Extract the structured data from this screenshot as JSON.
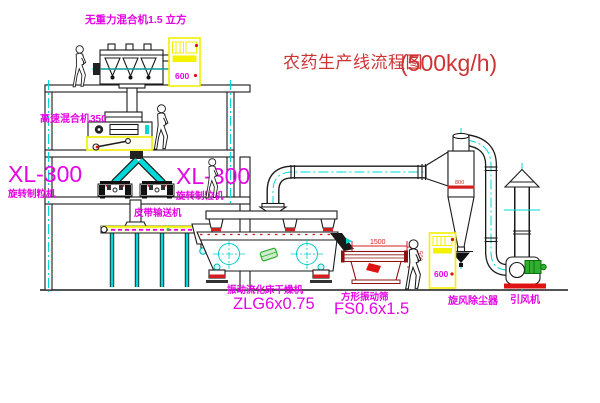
{
  "title": {
    "name": "农药生产线流程图",
    "capacity": "(500kg/h)"
  },
  "labels": {
    "gravity_mixer": "无重力混合机1.5 立方",
    "high_speed_mixer": "高速混合机350",
    "granulator_left_model": "XL-300",
    "granulator_left_name": "旋转制粒机",
    "granulator_right_model": "XL-300",
    "granulator_right_name": "旋转制粒机",
    "belt_conveyor": "皮带输送机",
    "dryer_name": "振动流化床干燥机",
    "dryer_model": "ZLG6x0.75",
    "sieve_name": "方形振动筛",
    "sieve_model": "FS0.6x1.5",
    "cyclone": "旋风除尘器",
    "fan": "引风机"
  },
  "dimensions": {
    "sieve_length": "1500",
    "sieve_height": "500",
    "cyclone_diameter": "800",
    "cabinet_top": "600",
    "cabinet_right": "600"
  },
  "colors": {
    "label_magenta": "#e505e5",
    "title_red": "#cc3434",
    "line_black": "#1a1a1a",
    "centerline_cyan": "#00d9d9",
    "highlight_yellow": "#f0f000",
    "accent_red": "#e01111",
    "accent_green": "#2fae2f",
    "sieve_dark_red": "#8c1111"
  }
}
